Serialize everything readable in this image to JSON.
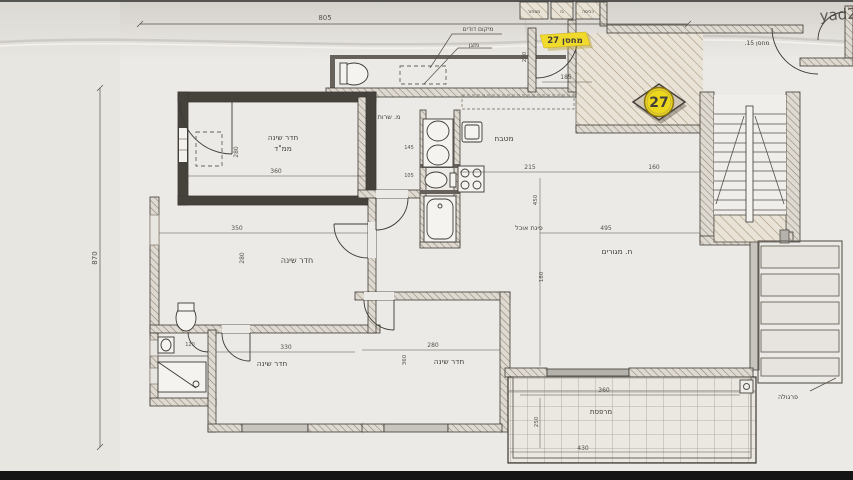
{
  "labels": {
    "bedroom_mamad_1": "חדר שינה",
    "bedroom_mamad_2": "ממ\"ד",
    "bedroom_left": "חדר שינה",
    "bedroom_bottom_left": "חדר שינה",
    "bedroom_bottom_mid": "חדר שינה",
    "kitchen": "מטבח",
    "service": "מ. שרות",
    "dining": "פינת אוכל",
    "living": "ח. מגורים",
    "balcony": "מרפסת",
    "pergola": "פרגולה",
    "storage_tag": "מחסן 27",
    "storage_badge": "27",
    "storage_neighbor": "מחסן 15.",
    "boiler_note": "מיקום דודים",
    "ac_note": "מזגן",
    "closet_left": "מסתור",
    "closet_mid": "גז",
    "closet_right": "כביסה",
    "watermark": "yad2"
  },
  "dimensions": {
    "total_width": "805",
    "total_height": "870",
    "mamad_width": "360",
    "mamad_height": "280",
    "bedroom_left_width": "350",
    "bedroom_left_height": "280",
    "bedroom_bl_width": "330",
    "bedroom_bm_width": "280",
    "bedroom_bm_height": "360",
    "hall_width": "215",
    "hall_to_stairs": "160",
    "entry_width": "185",
    "entry_depth": "200",
    "living_width": "495",
    "living_height": "450",
    "living_inner": "180",
    "bath_width": "120",
    "service_a": "145",
    "service_b": "105",
    "balcony_width": "360",
    "balcony_outer": "430",
    "balcony_depth": "250"
  },
  "colors": {
    "highlight_yellow": "#f0da2b",
    "badge_yellow": "#ecd71d",
    "paper": "#eceae6",
    "ink": "#3d3a35"
  }
}
